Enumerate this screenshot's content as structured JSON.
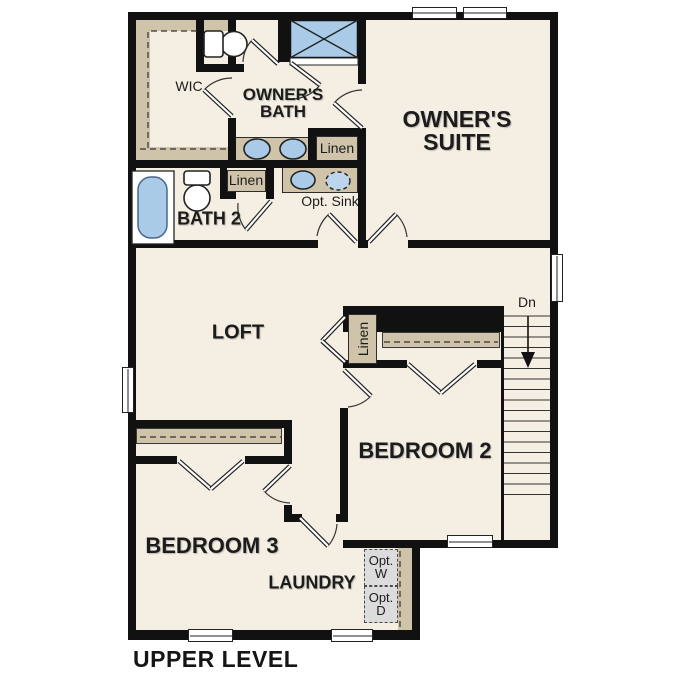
{
  "plan": {
    "level_label": "UPPER LEVEL",
    "colors": {
      "wall": "#111111",
      "floor": "#f5efe3",
      "cabinet_tan": "#cfc3aa",
      "fixture_blue": "#a9cbe8",
      "optional_gray": "#dcdcdc",
      "background": "#ffffff"
    },
    "rooms": {
      "owners_suite": {
        "line1": "OWNER'S",
        "line2": "SUITE"
      },
      "owners_bath": {
        "line1": "OWNER'S",
        "line2": "BATH"
      },
      "wic": {
        "label": "WIC"
      },
      "bath2": {
        "label": "BATH 2"
      },
      "loft": {
        "label": "LOFT"
      },
      "bedroom2": {
        "label": "BEDROOM 2"
      },
      "bedroom3": {
        "label": "BEDROOM 3"
      },
      "laundry": {
        "label": "LAUNDRY"
      }
    },
    "closets": {
      "owners_hall": "Linen",
      "bath2_hall": "Linen",
      "stair": "Linen"
    },
    "fixtures": {
      "opt_sink": "Opt. Sink",
      "opt_washer": {
        "line1": "Opt.",
        "line2": "W"
      },
      "opt_dryer": {
        "line1": "Opt.",
        "line2": "D"
      }
    },
    "stairs": {
      "direction_label": "Dn",
      "tread_count": 18
    }
  }
}
